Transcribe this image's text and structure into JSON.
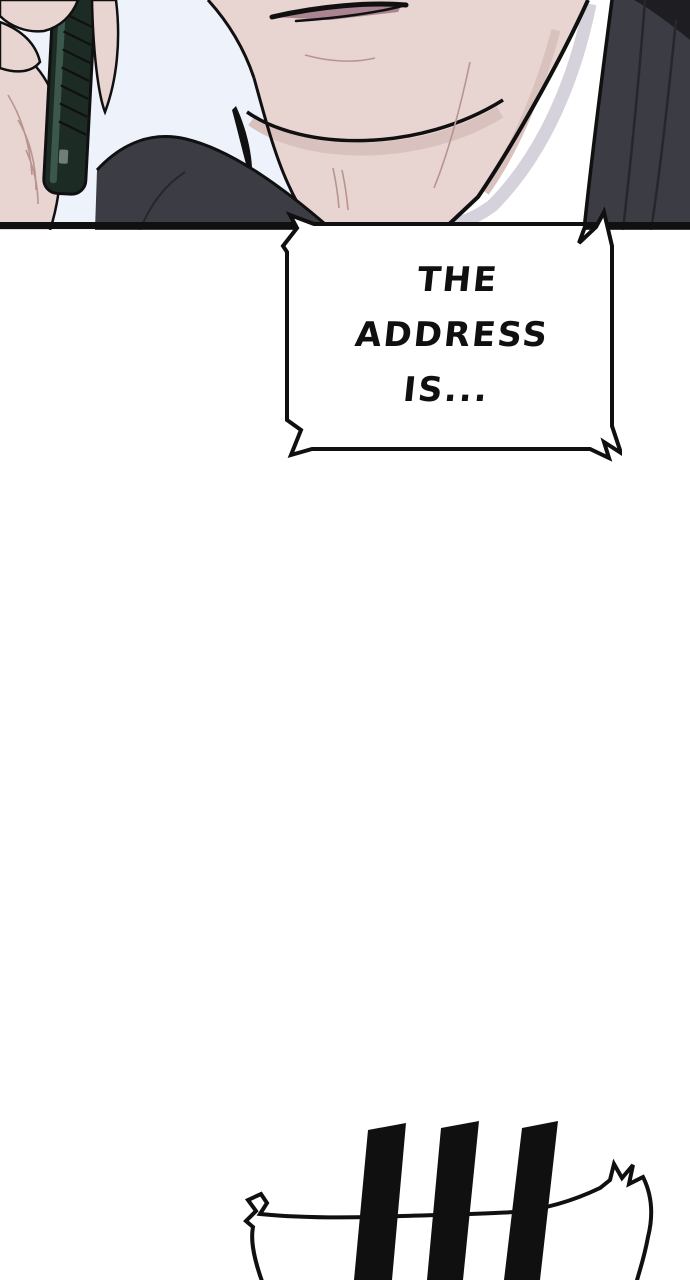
{
  "scene": {
    "type": "webtoon comic strip segment",
    "speech_bubble": {
      "style": "electric-jagged rectangle (phone-call bubble)",
      "lines": [
        "THE",
        "ADDRESS",
        "IS..."
      ]
    },
    "sfx": {
      "name": "emphasis-bars",
      "bar_count": 3,
      "shout_bubble_partial": true
    },
    "colors": {
      "background": "#ffffff",
      "ink": "#101010",
      "skin": "#e8d4d1",
      "skin_shadow": "#d9c1be",
      "skin_line": "#b9948f",
      "lips": "#aa8490",
      "sky": "#eef3fb",
      "shirt": "#ffffff",
      "shirt_shade": "#d6d2db",
      "jacket": "#3c3c44",
      "jacket_fold": "#26262c",
      "jacket_dark": "#1d1d22",
      "phone_body": "#1d2b25",
      "phone_edge": "#3c584c",
      "phone_detail": "#6e7f78"
    }
  }
}
